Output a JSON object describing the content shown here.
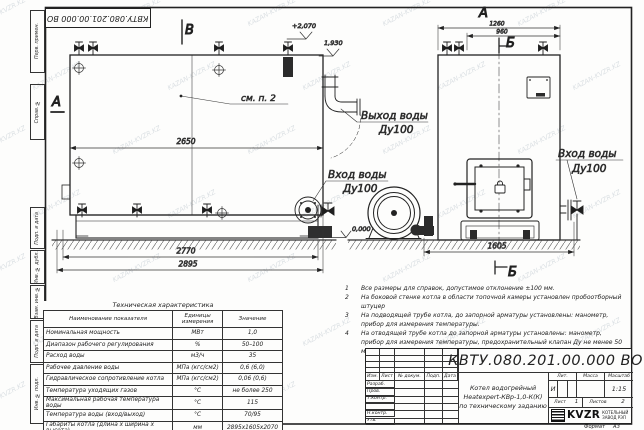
{
  "watermark": {
    "text": "KAZAN-KVZR.KZ"
  },
  "stamp_top": "КВТУ.080.201.00.000  ВО",
  "margin_left": {
    "boxes": [
      "Перв. примен.",
      "Справ. №",
      "Подп. и дата",
      "Инв. № дубл.",
      "Взам. инв. №",
      "Подп. и дата",
      "Инв. № подл."
    ]
  },
  "drawing": {
    "view_labels": {
      "front": "А",
      "b_top": "Б",
      "v_top": "В",
      "a_side": "А",
      "b_bottom": "Б"
    },
    "elevations": {
      "roof": "+2,070",
      "outlet": "1,930",
      "ground": "0,000"
    },
    "callouts": {
      "see_note": "см. п. 2"
    },
    "pipe_labels": {
      "outlet_line1": "Выход воды",
      "outlet_line2": "Ду100",
      "inlet_left_line1": "Вход воды",
      "inlet_left_line2": "Ду100",
      "inlet_right_line1": "Вход воды",
      "inlet_right_line2": "Ду100"
    },
    "dims": {
      "side_top": "2650",
      "side_bottom1": "2770",
      "side_bottom2": "2895",
      "front_top1": "1260",
      "front_top2": "960",
      "front_bottom": "1605"
    }
  },
  "notes": [
    {
      "num": "1",
      "text": "Все размеры для справок, допустимое отклонение ±100 мм."
    },
    {
      "num": "2",
      "text": "На боковой стенке котла в области топочной камеры установлен пробоотборный штуцер"
    },
    {
      "num": "3",
      "text": "На подводящей трубе котла, до запорной арматуры установлены: манометр, прибор для измерения температуры."
    },
    {
      "num": "4",
      "text": "На отводящей трубе котла до запорной арматуры установлены: манометр, прибор для измерения температуры, предохранительный клапан Ду не менее 50 мм и обвод с обратным клапаном Ду не менее 50 мм."
    }
  ],
  "tech_table": {
    "title": "Техническая характеристика",
    "headers": [
      "Наименование показателя",
      "Единицы измерения",
      "Значение"
    ],
    "rows": [
      {
        "name": "Номинальная мощность",
        "unit": "МВт",
        "value": "1,0"
      },
      {
        "name": "Диапазон рабочего регулирования",
        "unit": "%",
        "value": "50–100"
      },
      {
        "name": "Расход воды",
        "unit": "м3/ч",
        "value": "35"
      },
      {
        "name": "Рабочее давление воды",
        "unit": "МПа (кгс/см2)",
        "value": "0,6 (6,0)"
      },
      {
        "name": "Гидравлическое сопротивление котла",
        "unit": "МПа (кгс/см2)",
        "value": "0,06 (0,6)"
      },
      {
        "name": "Температура уходящих газов",
        "unit": "°С",
        "value": "не более 250"
      },
      {
        "name": "Максимальная рабочая температура воды",
        "unit": "°С",
        "value": "115"
      },
      {
        "name": "Температура воды (вход/выход)",
        "unit": "°С",
        "value": "70/95"
      },
      {
        "name": "Габариты котла (длина х ширина х высота)",
        "unit": "мм",
        "value": "2895х1605х2070"
      }
    ]
  },
  "title_block": {
    "doc_number": "КВТУ.080.201.00.000  ВО",
    "name_line1": "Котел водогрейный",
    "name_line2": "Heatexpert-КВр-1,0-К(К)",
    "name_line3": "по техническому заданию",
    "header_cols": [
      "Изм.",
      "Лист",
      "№ докум.",
      "Подп.",
      "Дата"
    ],
    "row_labels": [
      "Разраб.",
      "Пров.",
      "Т.контр.",
      "",
      "Н.контр.",
      "Утв."
    ],
    "lit_label": "Лит.",
    "mass_label": "Масса",
    "scale_label": "Масштаб",
    "lit_value": "И",
    "scale_value": "1:15",
    "sheet_label": "Лист",
    "sheet_value": "1",
    "sheets_label": "Листов",
    "sheets_value": "2",
    "company_logo": "KVZR",
    "company_name_line1": "КОТЕЛЬНЫЙ",
    "company_name_line2": "ЗАВОД РЭП",
    "format_label": "Формат",
    "format_value": "А3"
  }
}
